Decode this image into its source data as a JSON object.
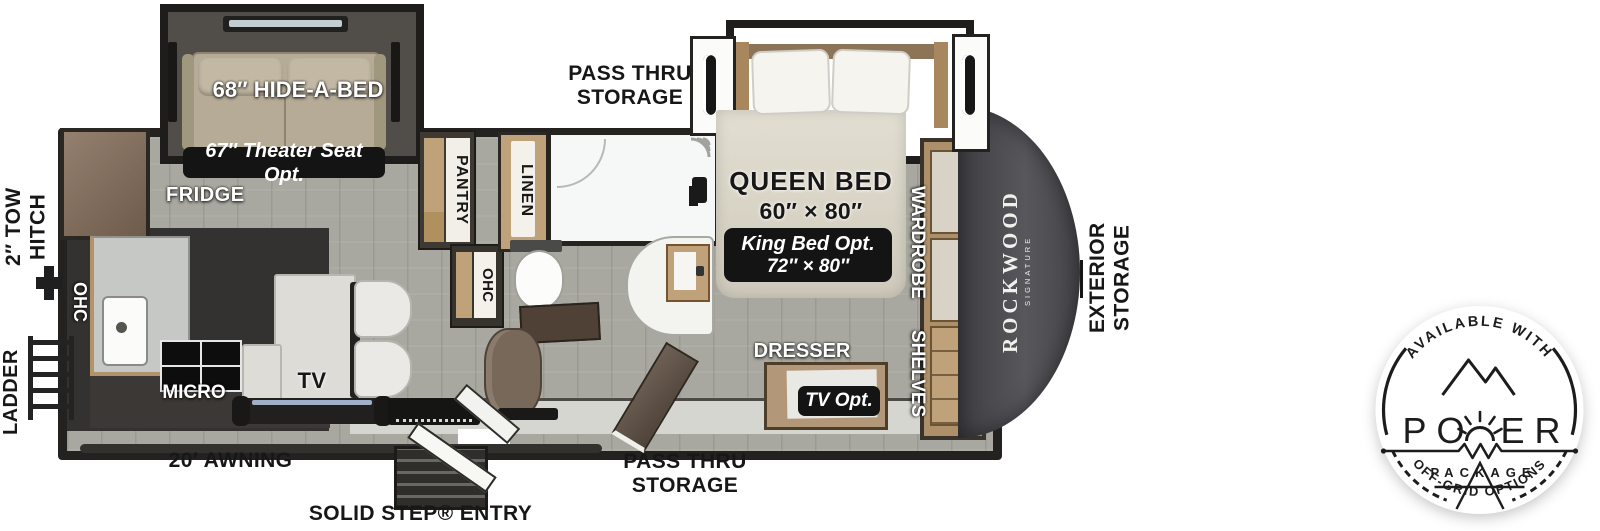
{
  "labels": {
    "pass_thru_storage_top": "PASS THRU STORAGE",
    "pass_thru_storage_bottom": "PASS THRU STORAGE",
    "tow_hitch": "2″ TOW HITCH",
    "ladder": "LADDER",
    "exterior_storage": "EXTERIOR STORAGE",
    "awning": "20′ AWNING",
    "entry": "SOLID STEP® ENTRY",
    "hide_a_bed": "68″ HIDE-A-BED",
    "theater_seat_opt": "67″ Theater Seat Opt.",
    "fridge": "FRIDGE",
    "pantry": "PANTRY",
    "linen": "LINEN",
    "ohc": "OHC",
    "micro": "MICRO",
    "tv": "TV",
    "queen_bed": "QUEEN BED",
    "queen_size": "60″ × 80″",
    "king_opt": "King Bed Opt.",
    "king_size": "72″ × 80″",
    "wardrobe": "WARDROBE",
    "shelves": "SHELVES",
    "dresser": "DRESSER",
    "tv_opt": "TV Opt."
  },
  "brand": {
    "name": "ROCKWOOD",
    "series": "SIGNATURE"
  },
  "power_badge": {
    "arc_top": "AVAILABLE WITH",
    "word_start": "PO",
    "word_end": "ER",
    "package": "PACKAGE",
    "arc_bottom": "OFF-GRID OPTIONS"
  },
  "colors": {
    "floor": "#a8a8a0",
    "wall": "#232220",
    "wood": "#c0a27a",
    "cap": "#4a4a4f",
    "badge_bg": "#141414",
    "label_dark": "#171717"
  }
}
